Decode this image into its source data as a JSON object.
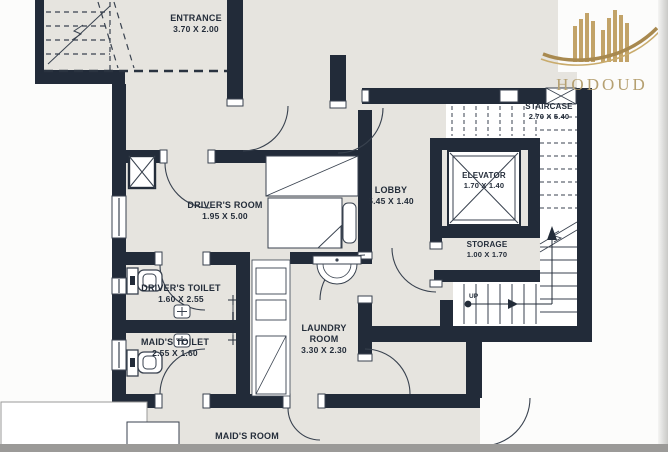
{
  "brand": {
    "name": "HODOUD",
    "logo_icon": "gold-towers-swoosh-icon",
    "gold": "#c2a368"
  },
  "rooms": [
    {
      "id": "entrance",
      "name": "ENTRANCE",
      "dims": "3.70 X 2.00"
    },
    {
      "id": "drivers-room",
      "name": "DRIVER'S ROOM",
      "dims": "1.95 X 5.00"
    },
    {
      "id": "lobby",
      "name": "LOBBY",
      "dims": "5.45 X 1.40"
    },
    {
      "id": "staircase",
      "name": "STAIRCASE",
      "dims": "2.70 X 5.40"
    },
    {
      "id": "elevator",
      "name": "ELEVATOR",
      "dims": "1.70 X 1.40"
    },
    {
      "id": "storage",
      "name": "STORAGE",
      "dims": "1.00 X 1.70"
    },
    {
      "id": "drivers-toilet",
      "name": "DRIVER'S TOILET",
      "dims": "1.60 X 2.55"
    },
    {
      "id": "maids-toilet",
      "name": "MAID'S TOILET",
      "dims": "2.55 X 1.60"
    },
    {
      "id": "laundry-room",
      "name": "LAUNDRY ROOM",
      "dims": "3.30 X 2.30"
    },
    {
      "id": "maids-room",
      "name": "MAID'S ROOM",
      "dims": ""
    }
  ],
  "annotations": {
    "stair_direction": "UP"
  },
  "colors": {
    "wall": "#222b39",
    "floor": "#e6e4df",
    "line": "#39424f",
    "text": "#242d3a",
    "logo_gold": "#c2a368"
  }
}
